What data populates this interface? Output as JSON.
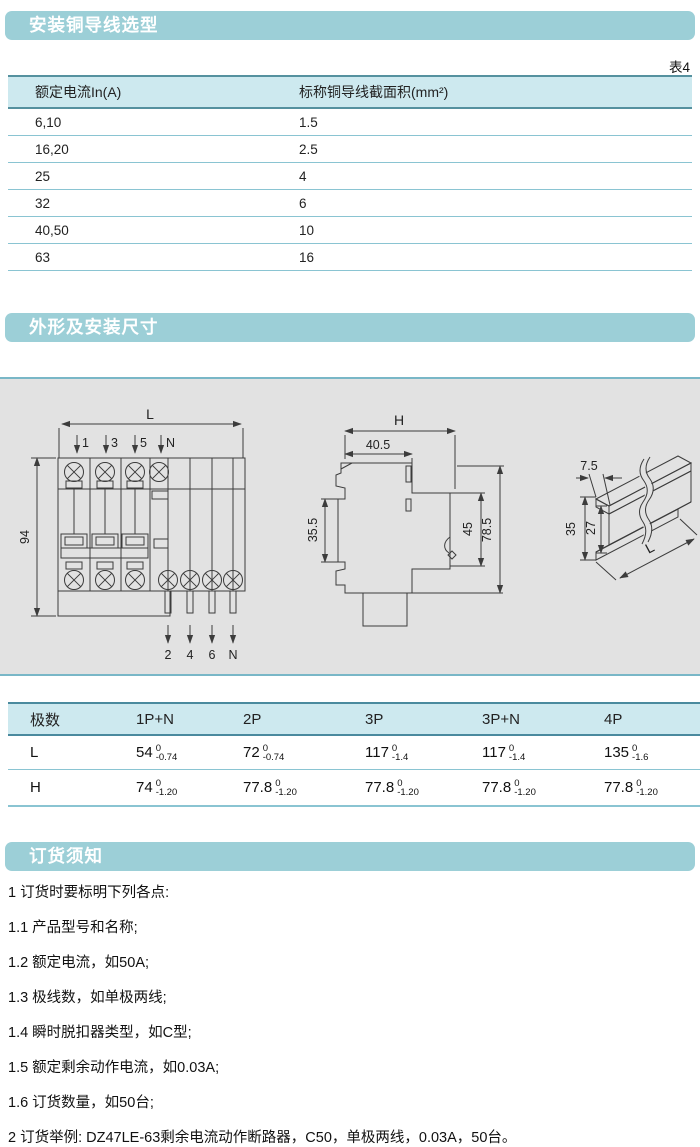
{
  "page": {
    "accent_teal": "#9ccfd7",
    "table_header_bg": "#cde9ef",
    "line_blue": "#8ac4d2",
    "line_dark": "#55919f",
    "panel_bg": "#e2e2e2"
  },
  "sections": {
    "wire": {
      "title": "安装铜导线选型",
      "table_label": "表4",
      "table": {
        "headers": [
          "额定电流In(A)",
          "标称铜导线截面积(mm²)"
        ],
        "rows": [
          [
            "6,10",
            "1.5"
          ],
          [
            "16,20",
            "2.5"
          ],
          [
            "25",
            "4"
          ],
          [
            "32",
            "6"
          ],
          [
            "40,50",
            "10"
          ],
          [
            "63",
            "16"
          ]
        ]
      }
    },
    "dimensions": {
      "title": "外形及安装尺寸",
      "drawing": {
        "front": {
          "dim_width": "L",
          "dim_height": "94",
          "top_terminals": [
            "1",
            "3",
            "5",
            "N"
          ],
          "bottom_terminals": [
            "2",
            "4",
            "6",
            "N"
          ]
        },
        "side": {
          "dim_total_width": "H",
          "dim_top_width": "40.5",
          "dim_left_height": "35.5",
          "dim_front_height": "45",
          "dim_total_height": "78.5"
        },
        "rail": {
          "dim_depth": "7.5",
          "dim_height": "35",
          "dim_inner_height": "27",
          "dim_length": "L"
        }
      },
      "dim_table": {
        "headers": [
          "极数",
          "1P+N",
          "2P",
          "3P",
          "3P+N",
          "4P"
        ],
        "rows": [
          {
            "label": "L",
            "cells": [
              {
                "v": "54",
                "up": "0",
                "dn": "-0.74"
              },
              {
                "v": "72",
                "up": "0",
                "dn": "-0.74"
              },
              {
                "v": "117",
                "up": "0",
                "dn": "-1.4"
              },
              {
                "v": "117",
                "up": "0",
                "dn": "-1.4"
              },
              {
                "v": "135",
                "up": "0",
                "dn": "-1.6"
              }
            ]
          },
          {
            "label": "H",
            "cells": [
              {
                "v": "74",
                "up": "0",
                "dn": "-1.20"
              },
              {
                "v": "77.8",
                "up": "0",
                "dn": "-1.20"
              },
              {
                "v": "77.8",
                "up": "0",
                "dn": "-1.20"
              },
              {
                "v": "77.8",
                "up": "0",
                "dn": "-1.20"
              },
              {
                "v": "77.8",
                "up": "0",
                "dn": "-1.20"
              }
            ]
          }
        ]
      }
    },
    "ordering": {
      "title": "订货须知",
      "items": [
        "1 订货时要标明下列各点:",
        "1.1 产品型号和名称;",
        "1.2 额定电流，如50A;",
        "1.3 极线数，如单极两线;",
        "1.4 瞬时脱扣器类型，如C型;",
        "1.5 额定剩余动作电流，如0.03A;",
        "1.6 订货数量，如50台;",
        "2 订货举例: DZ47LE-63剩余电流动作断路器，C50，单极两线，0.03A，50台。"
      ]
    }
  }
}
